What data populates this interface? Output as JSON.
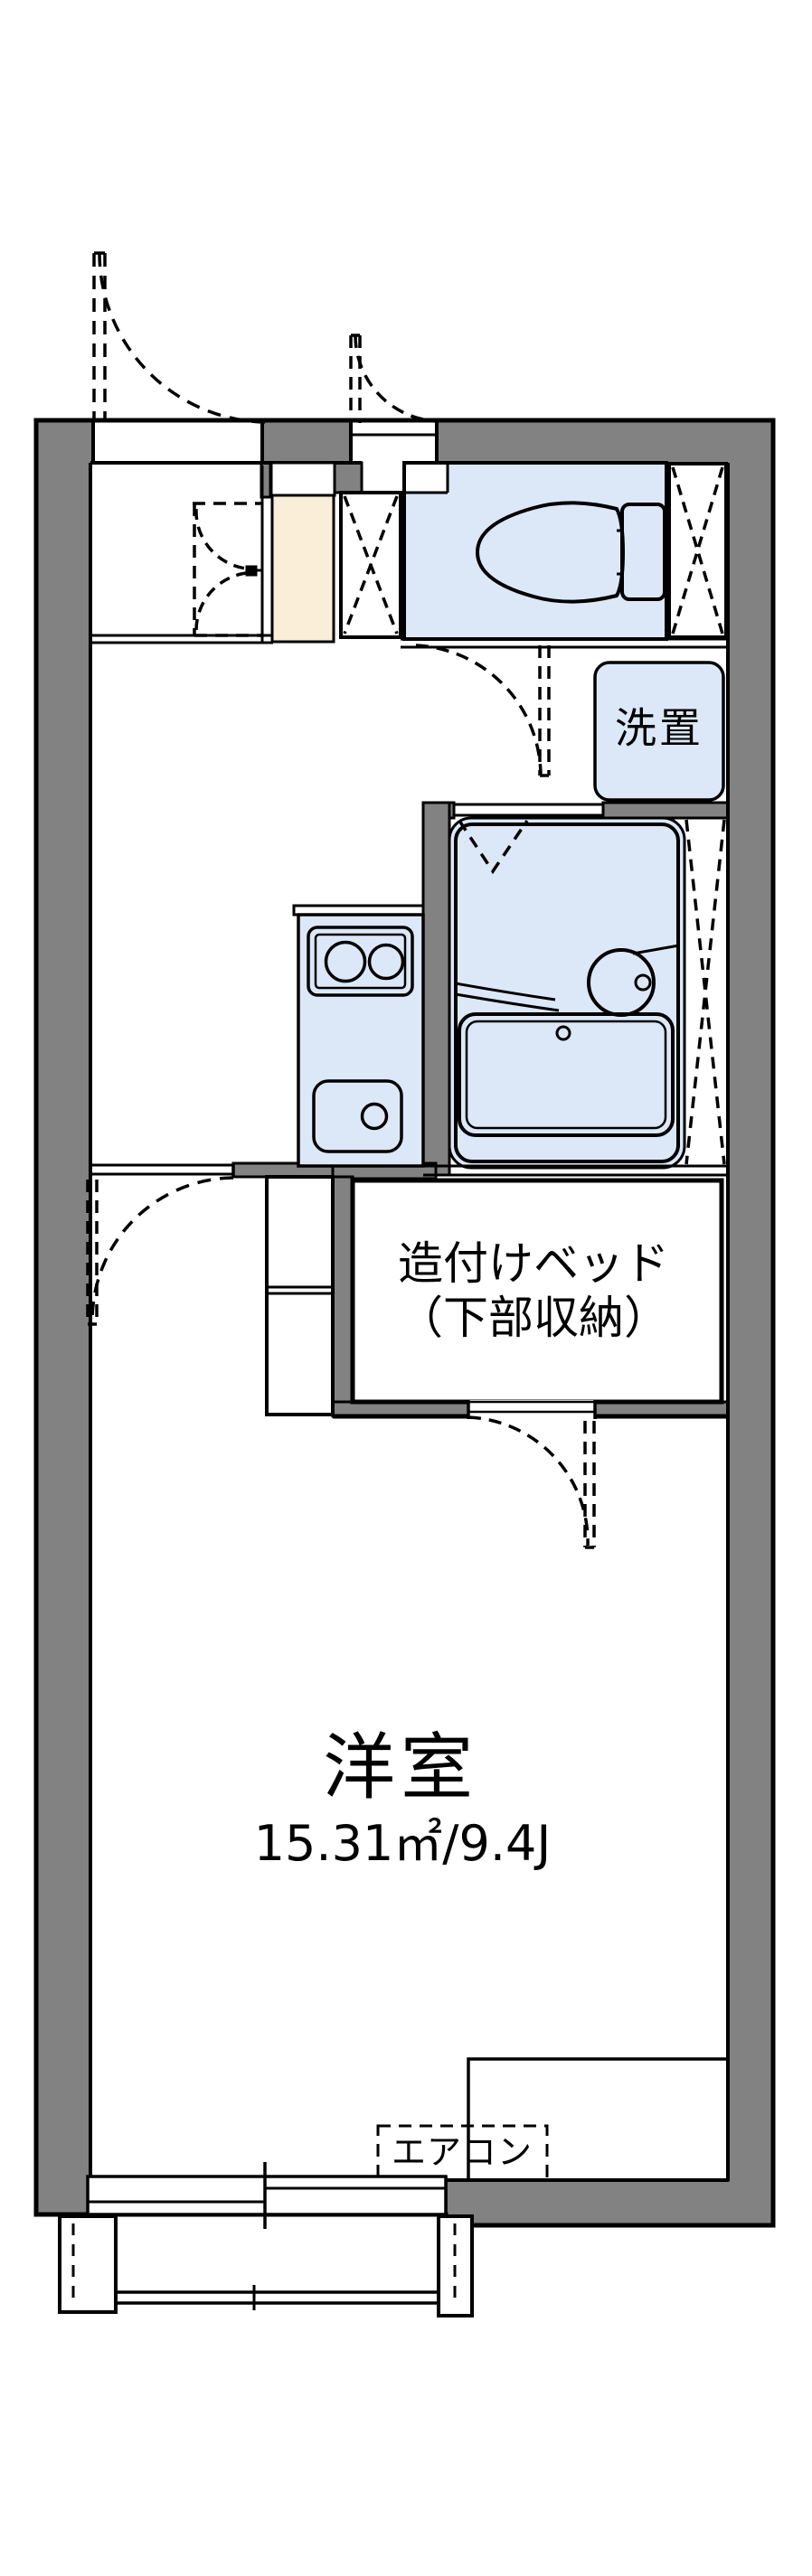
{
  "labels": {
    "washer_storage": "洗置",
    "built_in_bed_line1": "造付けベッド",
    "built_in_bed_line2": "（下部収納）",
    "western_room_name": "洋室",
    "western_room_area": "15.31㎡/9.4J",
    "air_conditioner": "エアコン"
  },
  "colors": {
    "wall_fill": "#828282",
    "wet_area_fill": "#dce8f8",
    "entrance_floor_fill": "#faeed8",
    "outline": "#000000",
    "background": "#ffffff"
  },
  "icons": [
    "toilet-icon",
    "washbasin-icon",
    "bathtub-icon",
    "stove-burners-icon",
    "kitchen-sink-icon",
    "door-swing-arc-icon",
    "crossed-box-icon"
  ]
}
